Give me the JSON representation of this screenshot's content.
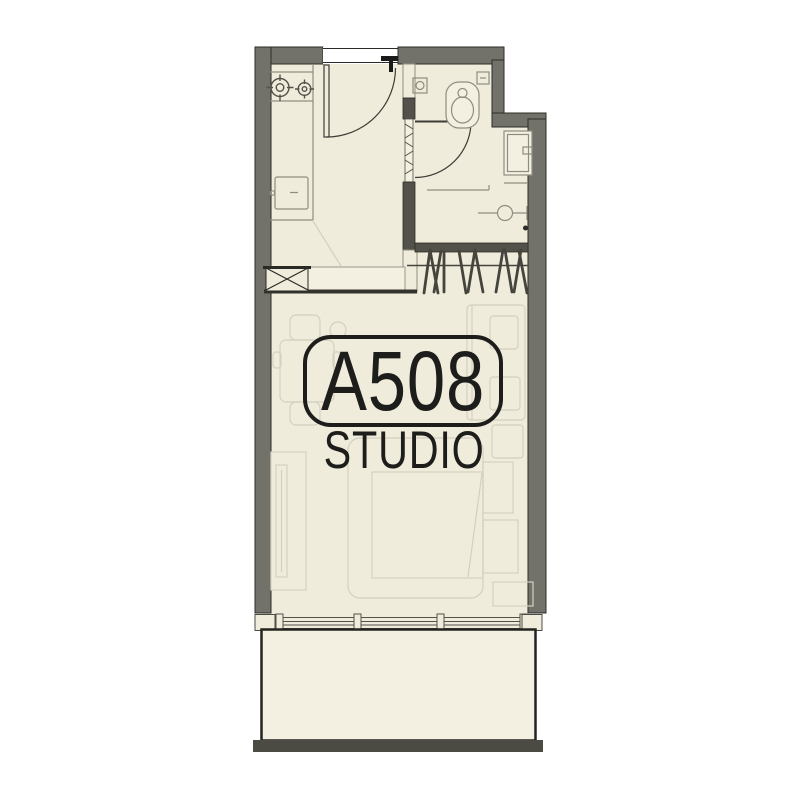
{
  "unit_label": {
    "number": "A508",
    "type": "STUDIO"
  },
  "colors": {
    "background": "#ffffff",
    "floor": "#f0ecdb",
    "floor_light": "#f3f0e2",
    "wall": "#73726a",
    "wall_dark": "#53524a",
    "outline": "#2c2c27",
    "fixture": "#8f8d80",
    "furniture": "#d4d0bf",
    "hanger": "#45443d",
    "door": "#3d3c36",
    "label": "#1d1d1b",
    "balcony_bar": "#4b4b44"
  },
  "icons": [
    "stove-burners-icon",
    "kitchen-sink-icon",
    "service-shaft-icon",
    "entry-door-icon",
    "bathroom-door-icon",
    "toilet-icon",
    "floor-drain-icon",
    "vanity-sink-icon",
    "shower-drain-icon",
    "clothes-hangers-icon",
    "dining-table-icon",
    "sofa-icon",
    "tv-console-icon",
    "bed-icon",
    "side-tables-icon",
    "window-wall-icon",
    "balcony-icon"
  ]
}
